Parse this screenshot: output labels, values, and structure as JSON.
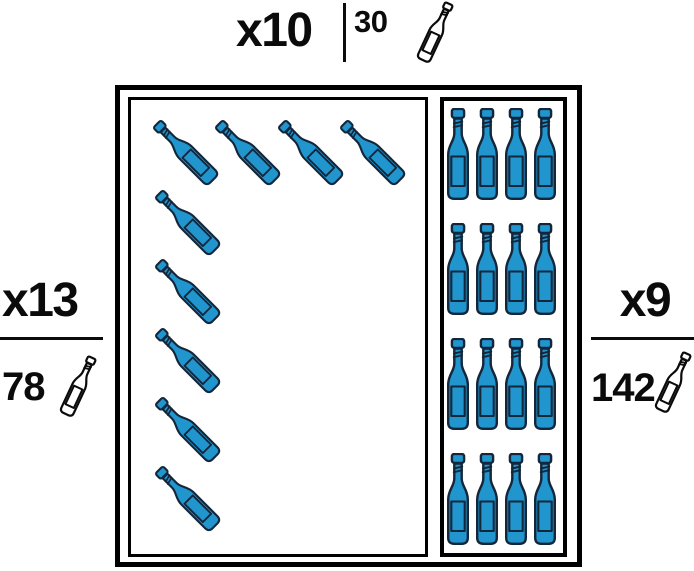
{
  "title": "Wine rack capacity diagram",
  "colors": {
    "bottle_fill": "#2095CE",
    "bottle_stroke": "#14263A",
    "line_black": "#0B0B0B"
  },
  "labels": {
    "top": {
      "multiplier": "x10",
      "count": "30",
      "icon": "wine-bottle-icon"
    },
    "left": {
      "multiplier": "x13",
      "count": "78",
      "icon": "wine-bottle-icon"
    },
    "right": {
      "multiplier": "x9",
      "count": "142",
      "icon": "wine-bottle-icon"
    }
  },
  "rack": {
    "tilted_bottles": {
      "top_row": 4,
      "left_column": 5,
      "total": 9
    },
    "upright_bottles": {
      "rows": 4,
      "cols": 4,
      "total": 16
    }
  }
}
